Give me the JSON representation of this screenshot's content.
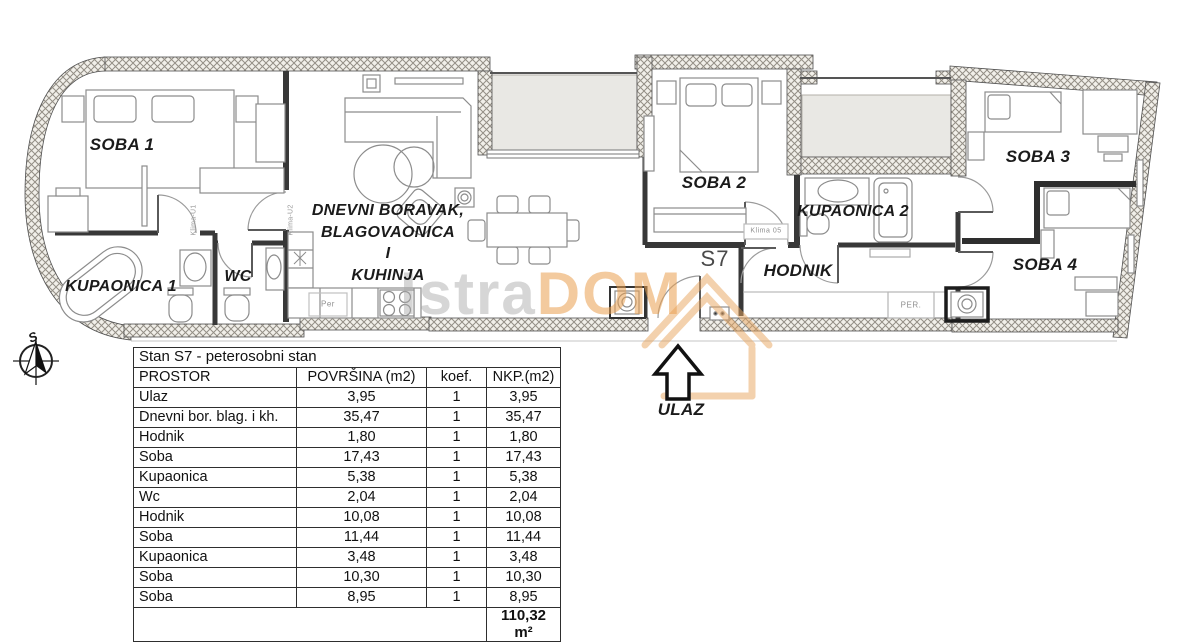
{
  "plan": {
    "unit": "S7",
    "rooms": {
      "soba1": "SOBA 1",
      "kupaonica1": "KUPAONICA 1",
      "wc": "WC",
      "living1": "DNEVNI BORAVAK,",
      "living2": "BLAGOVAONICA",
      "living3": "I",
      "living4": "KUHINJA",
      "soba2": "SOBA 2",
      "kupaonica2": "KUPAONICA 2",
      "hodnik": "HODNIK",
      "soba3": "SOBA 3",
      "soba4": "SOBA 4"
    },
    "annotations": {
      "entrance": "ULAZ",
      "compass_north": "S",
      "klima_u1": "Klima-U1",
      "klima_u2": "Klima-U2",
      "klima_05": "Klima 05",
      "per_small": "Per",
      "per_caps": "PER."
    },
    "watermark": {
      "part1": "Istra",
      "part2": "DOM"
    }
  },
  "table": {
    "title": "Stan S7 - peterosobni stan",
    "headers": [
      "PROSTOR",
      "POVRŠINA (m2)",
      "koef.",
      "NKP.(m2)"
    ],
    "rows": [
      [
        "Ulaz",
        "3,95",
        "1",
        "3,95"
      ],
      [
        "Dnevni bor. blag. i kh.",
        "35,47",
        "1",
        "35,47"
      ],
      [
        "Hodnik",
        "1,80",
        "1",
        "1,80"
      ],
      [
        "Soba",
        "17,43",
        "1",
        "17,43"
      ],
      [
        "Kupaonica",
        "5,38",
        "1",
        "5,38"
      ],
      [
        "Wc",
        "2,04",
        "1",
        "2,04"
      ],
      [
        "Hodnik",
        "10,08",
        "1",
        "10,08"
      ],
      [
        "Soba",
        "11,44",
        "1",
        "11,44"
      ],
      [
        "Kupaonica",
        "3,48",
        "1",
        "3,48"
      ],
      [
        "Soba",
        "10,30",
        "1",
        "10,30"
      ],
      [
        "Soba",
        "8,95",
        "1",
        "8,95"
      ]
    ],
    "total": "110,32 m²"
  },
  "colors": {
    "wall_hatch": "#938e85",
    "terrace": "#e9e8e4",
    "watermark_orange": "#e8a45e"
  }
}
